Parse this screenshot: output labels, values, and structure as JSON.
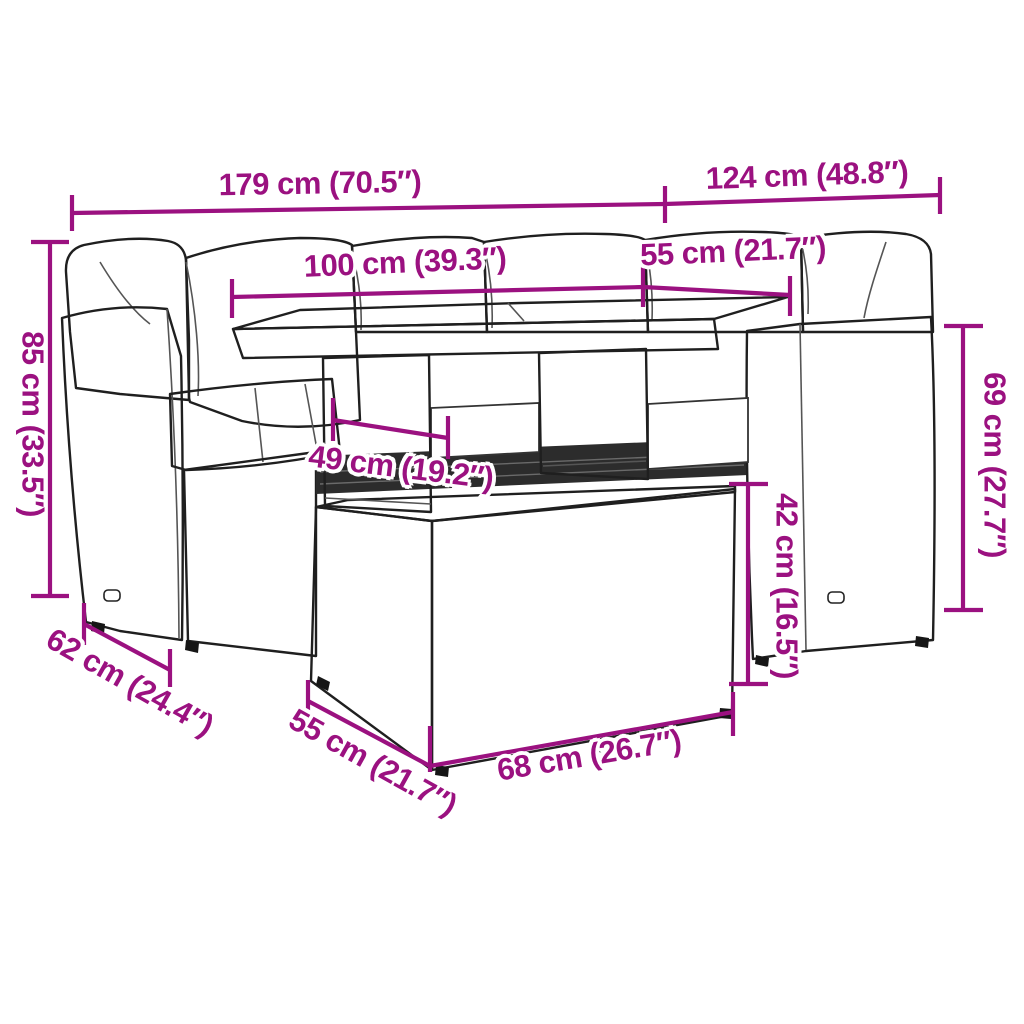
{
  "theme": {
    "accent": "#9B1180",
    "line_art": "#1F1F1F",
    "background": "#FFFFFF"
  },
  "diagram": {
    "subject": "rattan-garden-sofa-set-with-table-and-stool",
    "unit_style": "cm (inches)",
    "dim_labels": {
      "total_width": "179 cm (70.5″)",
      "side_width": "124 cm (48.8″)",
      "table_length": "100 cm (39.3″)",
      "table_depth": "55 cm (21.7″)",
      "back_height": "85 cm (33.5″)",
      "arm_height": "69 cm (27.7″)",
      "stool_height": "42 cm (16.5″)",
      "table_clearance": "49 cm (19.2″)",
      "seat_depth": "62 cm (24.4″)",
      "stool_depth": "55 cm (21.7″)",
      "stool_width": "68 cm (26.7″)"
    }
  }
}
